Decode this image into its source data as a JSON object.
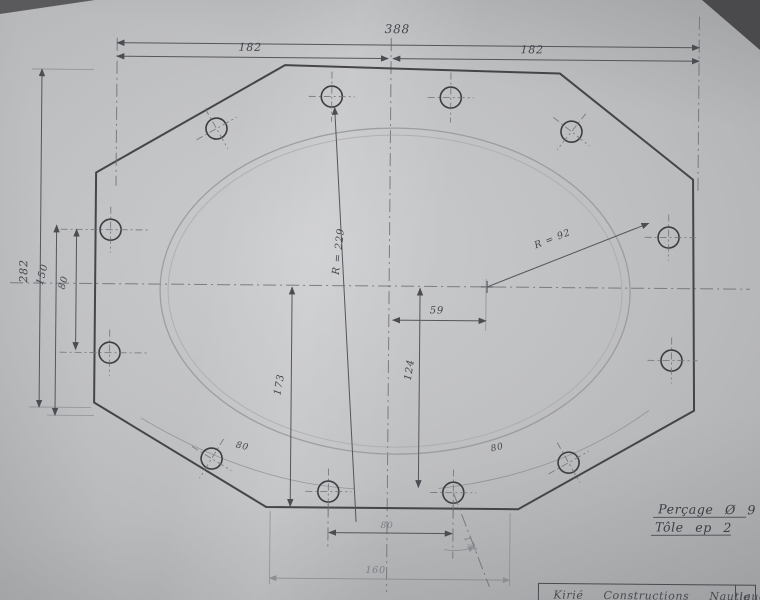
{
  "document": {
    "kind": "hand-drawn sheet-metal drawing (pencil on paper, photographed)",
    "part": "octagonal plate with elliptical cutout and 12 drilled holes"
  },
  "colors": {
    "paper": "#bdbec0",
    "pencil_dark": "#3b3b3f",
    "pencil_light": "#96969b"
  },
  "dimensions": {
    "overall_width": "388",
    "top_span_left": "182",
    "top_span_right": "182",
    "overall_height": "282",
    "left_span": "150",
    "left_hole_pitch": "80",
    "major_radius": "R = 229",
    "corner_radius": "R = 92",
    "horizontal_offset": "59",
    "vertical_offset_right": "124",
    "vertical_offset_left": "173",
    "arc_left": "80",
    "arc_right": "80",
    "bottom_hole_pitch": "80",
    "bottom_span": "160",
    "hole_angle": "17°"
  },
  "notes": {
    "drilling": "Perçage Ø 9",
    "sheet": "Tôle ep 2"
  },
  "title_block": {
    "line": "Kirié Constructions Nautiques",
    "date_note": "le 2"
  }
}
